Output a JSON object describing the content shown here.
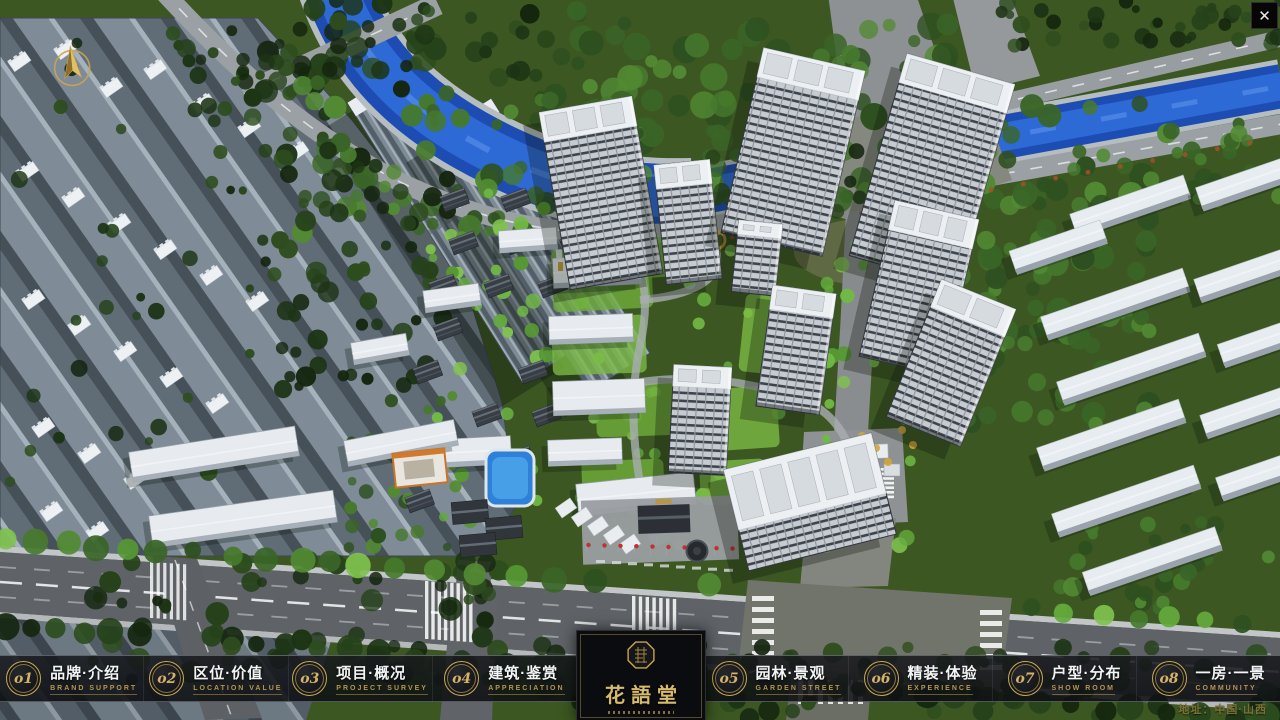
{
  "icons": {
    "close": "✕"
  },
  "nav": {
    "items": [
      {
        "num": "o1",
        "title": "品牌·介绍",
        "subtitle": "BRAND SUPPORT"
      },
      {
        "num": "o2",
        "title": "区位·价值",
        "subtitle": "LOCATION VALUE"
      },
      {
        "num": "o3",
        "title": "项目·概况",
        "subtitle": "PROJECT SURVEY"
      },
      {
        "num": "o4",
        "title": "建筑·鉴赏",
        "subtitle": "APPRECIATION"
      },
      {
        "num": "o5",
        "title": "园林·景观",
        "subtitle": "GARDEN STREET"
      },
      {
        "num": "o6",
        "title": "精装·体验",
        "subtitle": "EXPERIENCE"
      },
      {
        "num": "o7",
        "title": "户型·分布",
        "subtitle": "SHOW ROOM"
      },
      {
        "num": "o8",
        "title": "一房·一景",
        "subtitle": "COMMUNITY"
      }
    ]
  },
  "logo": {
    "name": "花語堂"
  },
  "footer": {
    "address": "地址：中国·山西"
  },
  "colors": {
    "gold": "#c9a851",
    "subtitle_gold": "#b59550",
    "river_blue": "#2f6bd8",
    "nav_text": "#f3f4f5"
  }
}
